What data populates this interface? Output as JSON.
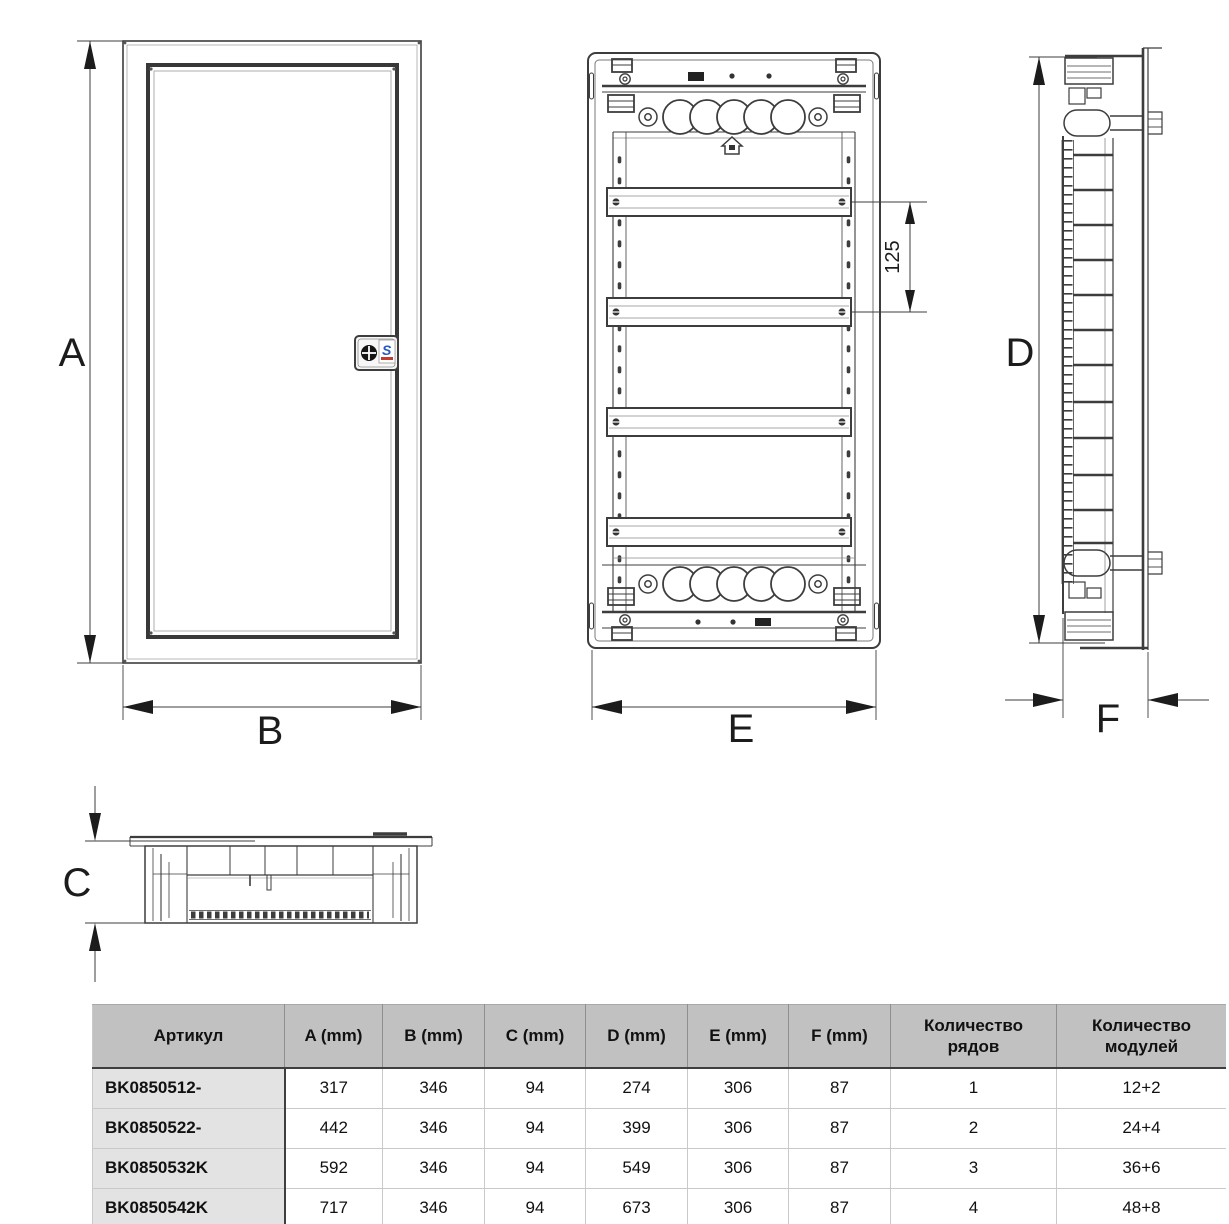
{
  "diagram": {
    "dim_labels": {
      "a": "A",
      "b": "B",
      "c": "C",
      "d": "D",
      "e": "E",
      "f": "F"
    },
    "rail_spacing_label": "125",
    "lock_letter": "S"
  },
  "table": {
    "headers": [
      "Артикул",
      "A (mm)",
      "B (mm)",
      "C (mm)",
      "D (mm)",
      "E (mm)",
      "F (mm)",
      "Количество рядов",
      "Количество модулей"
    ],
    "rows": [
      {
        "article": "BK0850512-",
        "a": "317",
        "b": "346",
        "c": "94",
        "d": "274",
        "e": "306",
        "f": "87",
        "num_rows": "1",
        "num_modules": "12+2"
      },
      {
        "article": "BK0850522-",
        "a": "442",
        "b": "346",
        "c": "94",
        "d": "399",
        "e": "306",
        "f": "87",
        "num_rows": "2",
        "num_modules": "24+4"
      },
      {
        "article": "BK0850532K",
        "a": "592",
        "b": "346",
        "c": "94",
        "d": "549",
        "e": "306",
        "f": "87",
        "num_rows": "3",
        "num_modules": "36+6"
      },
      {
        "article": "BK0850542K",
        "a": "717",
        "b": "346",
        "c": "94",
        "d": "673",
        "e": "306",
        "f": "87",
        "num_rows": "4",
        "num_modules": "48+8"
      }
    ]
  },
  "colors": {
    "line": "#3d3d3d",
    "header_bg": "#c1c1c1",
    "article_bg": "#e3e3e3",
    "lock_blue": "#2257c4",
    "lock_red": "#c23b2e"
  }
}
